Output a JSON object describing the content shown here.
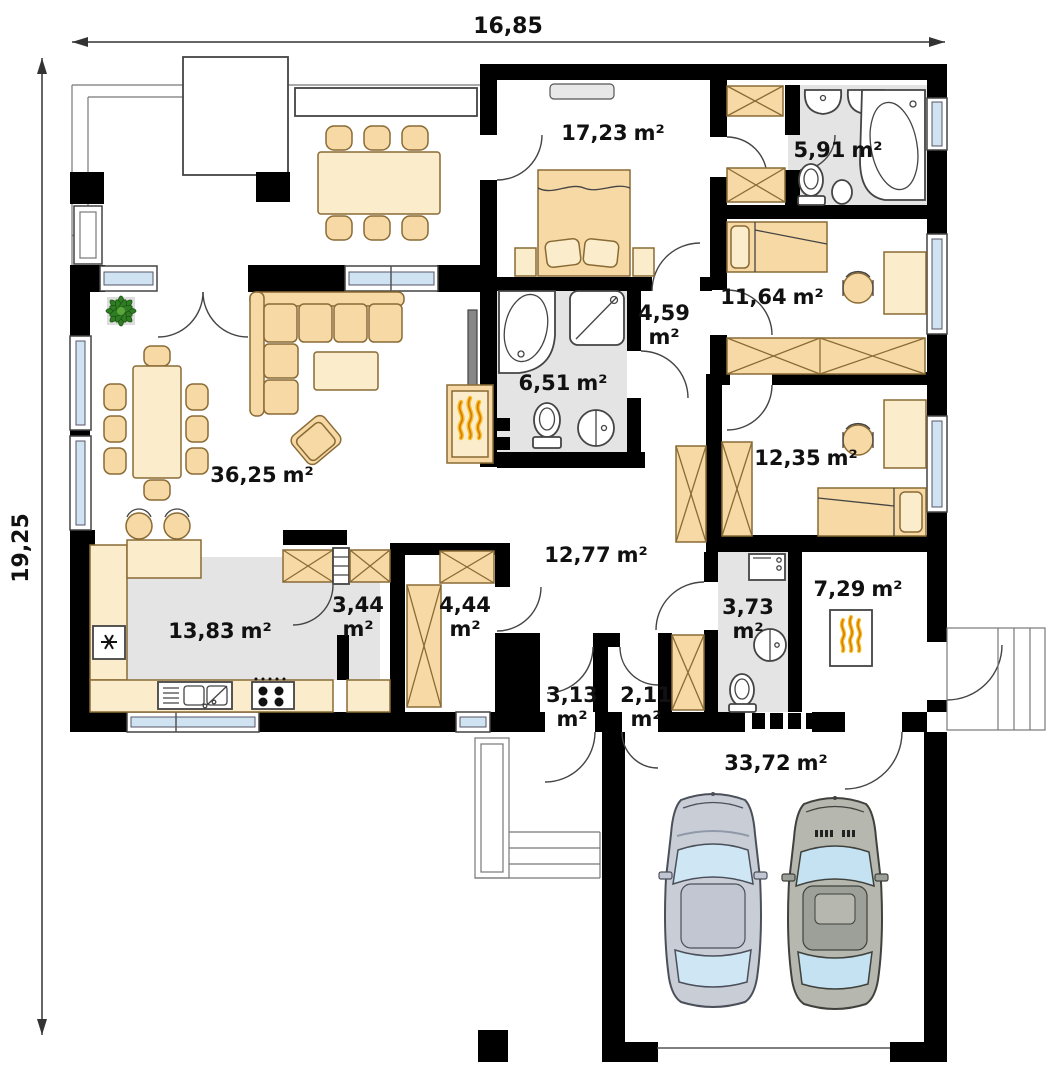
{
  "dimensions": {
    "width": "16,85",
    "height": "19,25"
  },
  "rooms": {
    "living_room": {
      "value": "36,25",
      "unit": "m²"
    },
    "kitchen": {
      "value": "13,83",
      "unit": "m²"
    },
    "pantry": {
      "value": "3,44",
      "unit": "m²"
    },
    "wardrobe_room": {
      "value": "4,44",
      "unit": "m²"
    },
    "master_bedroom": {
      "value": "17,23",
      "unit": "m²"
    },
    "bathroom_small": {
      "value": "5,91",
      "unit": "m²"
    },
    "bedroom_upper": {
      "value": "11,64",
      "unit": "m²"
    },
    "hallway_upper": {
      "value": "4,59",
      "unit": "m²"
    },
    "bathroom_main": {
      "value": "6,51",
      "unit": "m²"
    },
    "bedroom_lower": {
      "value": "12,35",
      "unit": "m²"
    },
    "hall": {
      "value": "12,77",
      "unit": "m²"
    },
    "entry": {
      "value": "3,13",
      "unit": "m²"
    },
    "vestibule": {
      "value": "2,11",
      "unit": "m²"
    },
    "wc": {
      "value": "3,73",
      "unit": "m²"
    },
    "boiler_room": {
      "value": "7,29",
      "unit": "m²"
    },
    "garage": {
      "value": "33,72",
      "unit": "m²"
    }
  },
  "colors": {
    "wall": "#000000",
    "wet_floor": "#e4e4e4",
    "furniture": "#f6d9a4",
    "furniture_light": "#fbeccb",
    "window_glass": "#cfe3f2",
    "flame_yellow": "#f6c026",
    "flame_orange": "#d97c10",
    "plant_green": "#2f7d23",
    "car_blue_grey": "#c9cdd6",
    "car_grey": "#b6b7af"
  }
}
